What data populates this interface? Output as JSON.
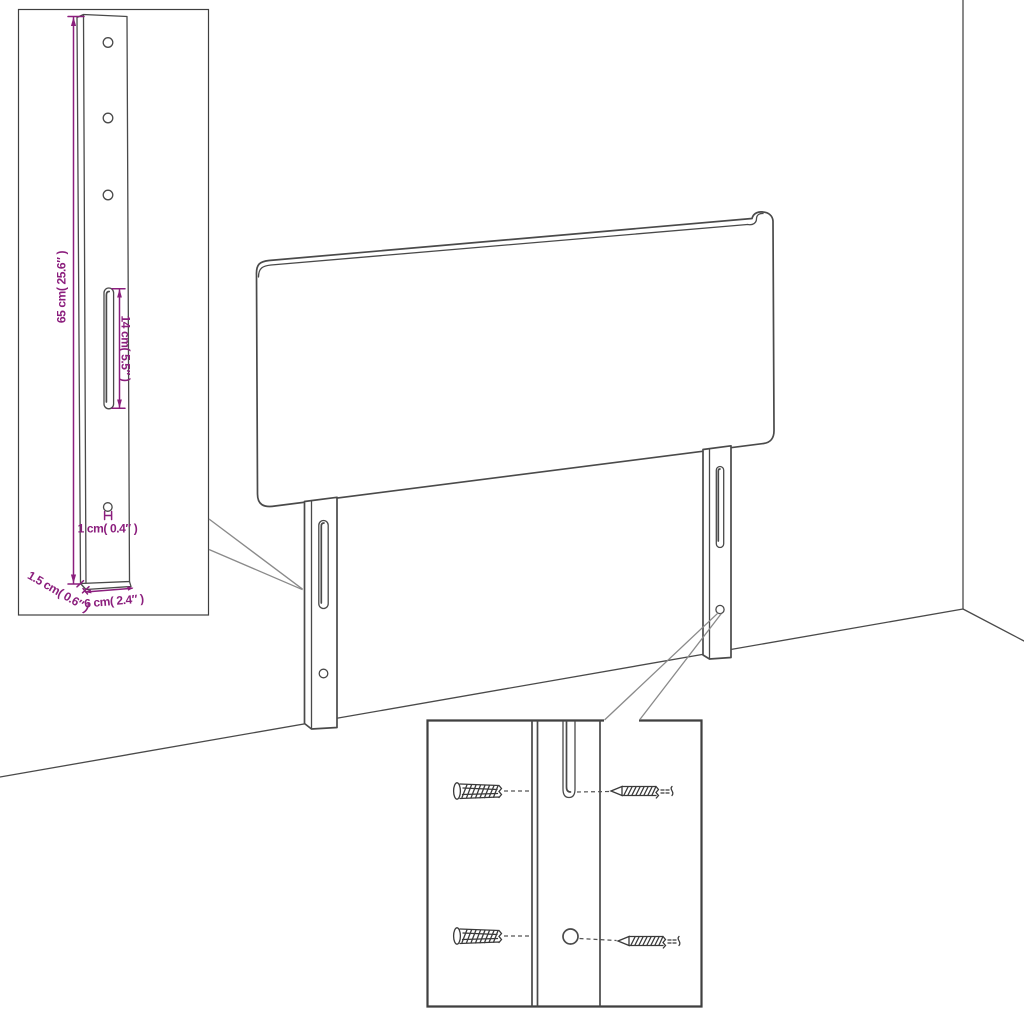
{
  "diagram": {
    "type": "furniture-assembly-line-drawing",
    "subject": "Headboard with two mounting legs shown against a room wall corner, with a bracket dimension inset and a wall-plug and screw hardware inset",
    "colors": {
      "background": "#ffffff",
      "line": "#4a4a4a",
      "leader": "#8a8a8a",
      "box_border": "#3f3f3f",
      "dimension": "#8b1e7d"
    },
    "bracket_detail": {
      "labels": {
        "height": "65 cm( 25.6″ )",
        "slot_length": "14 cm( 5.5″ )",
        "hole_diameter": "1 cm( 0.4″ )",
        "thickness": "1.5 cm( 0.6″ )",
        "width": "6 cm( 2.4″ )"
      },
      "top_holes": 3,
      "bottom_holes": 1,
      "slots": 1
    },
    "headboard": {
      "legs": 2,
      "slots_per_leg": 1,
      "holes_per_leg": 1
    },
    "hardware_detail": {
      "wall_plugs": 2,
      "screws": 2
    }
  }
}
